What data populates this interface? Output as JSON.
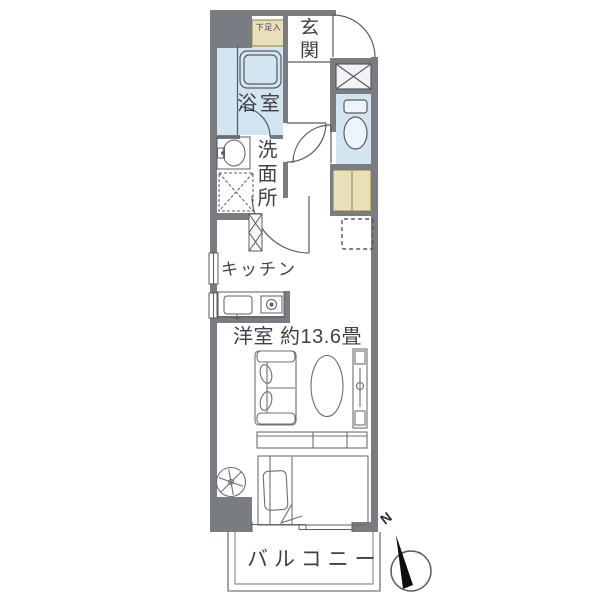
{
  "floorplan": {
    "labels": {
      "entrance": "玄関",
      "shoe_box": "下足入",
      "bathroom": "浴室",
      "washroom": "洗面所",
      "kitchen": "キッチン",
      "main_room": "洋室 約13.6畳",
      "balcony": "バルコニー"
    },
    "compass": {
      "north": "N"
    },
    "colors": {
      "wall": "#797d82",
      "water_room_fill": "#d2e5f1",
      "fixture_fill": "#eef5fa",
      "closet_fill": "#e9dfb9",
      "closet_border": "#a09257",
      "line": "#585c62",
      "furniture_line": "#6b6f74",
      "balcony_line": "#8b8e92",
      "compass_needle": "#0d0d0f",
      "text": "#3e4248"
    }
  }
}
